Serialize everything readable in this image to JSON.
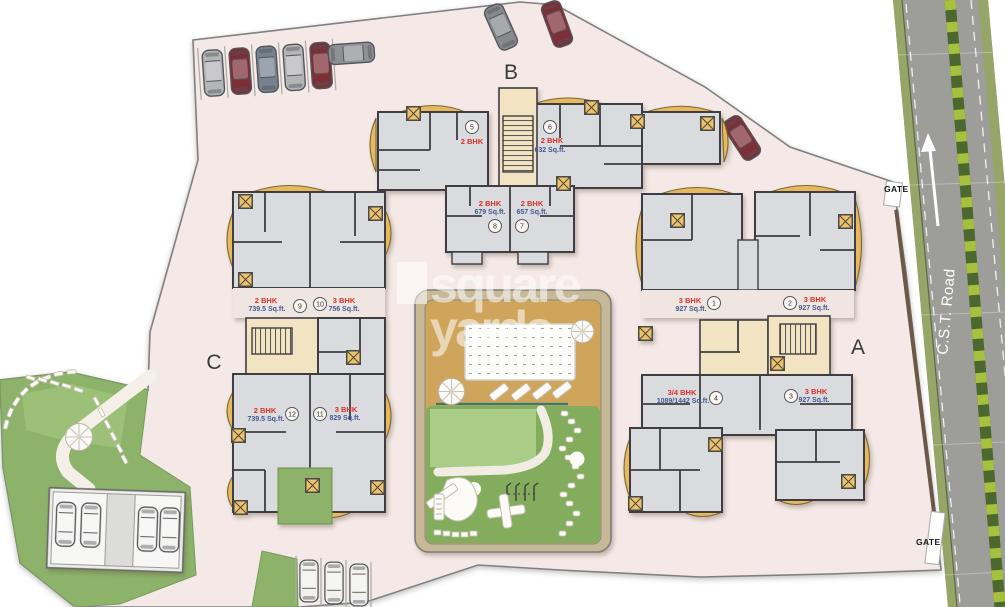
{
  "watermark": {
    "line1": "square",
    "line2": "yards"
  },
  "road": {
    "label": "C.S.T. Road"
  },
  "gates": {
    "top": "GATE",
    "bottom": "GATE"
  },
  "colors": {
    "site": "#f4e9e6",
    "room_gray": "#d9dbdf",
    "accent_tan": "#eec26b",
    "deck_tan": "#cfa55c",
    "lawn_green": "#83ad5c",
    "garden_green": "#8cb369",
    "road_gray": "#9d9d99",
    "median_light": "#a6c13e",
    "median_dark": "#4c682e",
    "unit_type_red": "#d93025",
    "unit_area_blue": "#44598f"
  },
  "buildings": [
    {
      "label": "A",
      "units": [
        {
          "no": "1",
          "type": "3 BHK",
          "area": "927 Sq.ft."
        },
        {
          "no": "2",
          "type": "3 BHK",
          "area": "927 Sq.ft."
        },
        {
          "no": "3",
          "type": "3 BHK",
          "area": "927 Sq.ft."
        },
        {
          "no": "4",
          "type": "3/4 BHK",
          "area": "1089/1442 Sq.ft."
        }
      ]
    },
    {
      "label": "B",
      "units": [
        {
          "no": "5",
          "type": "2 BHK",
          "area": ""
        },
        {
          "no": "6",
          "type": "2 BHK",
          "area": "632 Sq.ft."
        },
        {
          "no": "7",
          "type": "2 BHK",
          "area": "657 Sq.ft."
        },
        {
          "no": "8",
          "type": "2 BHK",
          "area": "679 Sq.ft."
        }
      ]
    },
    {
      "label": "C",
      "units": [
        {
          "no": "9",
          "type": "2 BHK",
          "area": "739.5 Sq.ft."
        },
        {
          "no": "10",
          "type": "3 BHK",
          "area": "756 Sq.ft."
        },
        {
          "no": "11",
          "type": "3 BHK",
          "area": "829 Sq.ft."
        },
        {
          "no": "12",
          "type": "2 BHK",
          "area": "739.5 Sq.ft."
        }
      ]
    }
  ]
}
